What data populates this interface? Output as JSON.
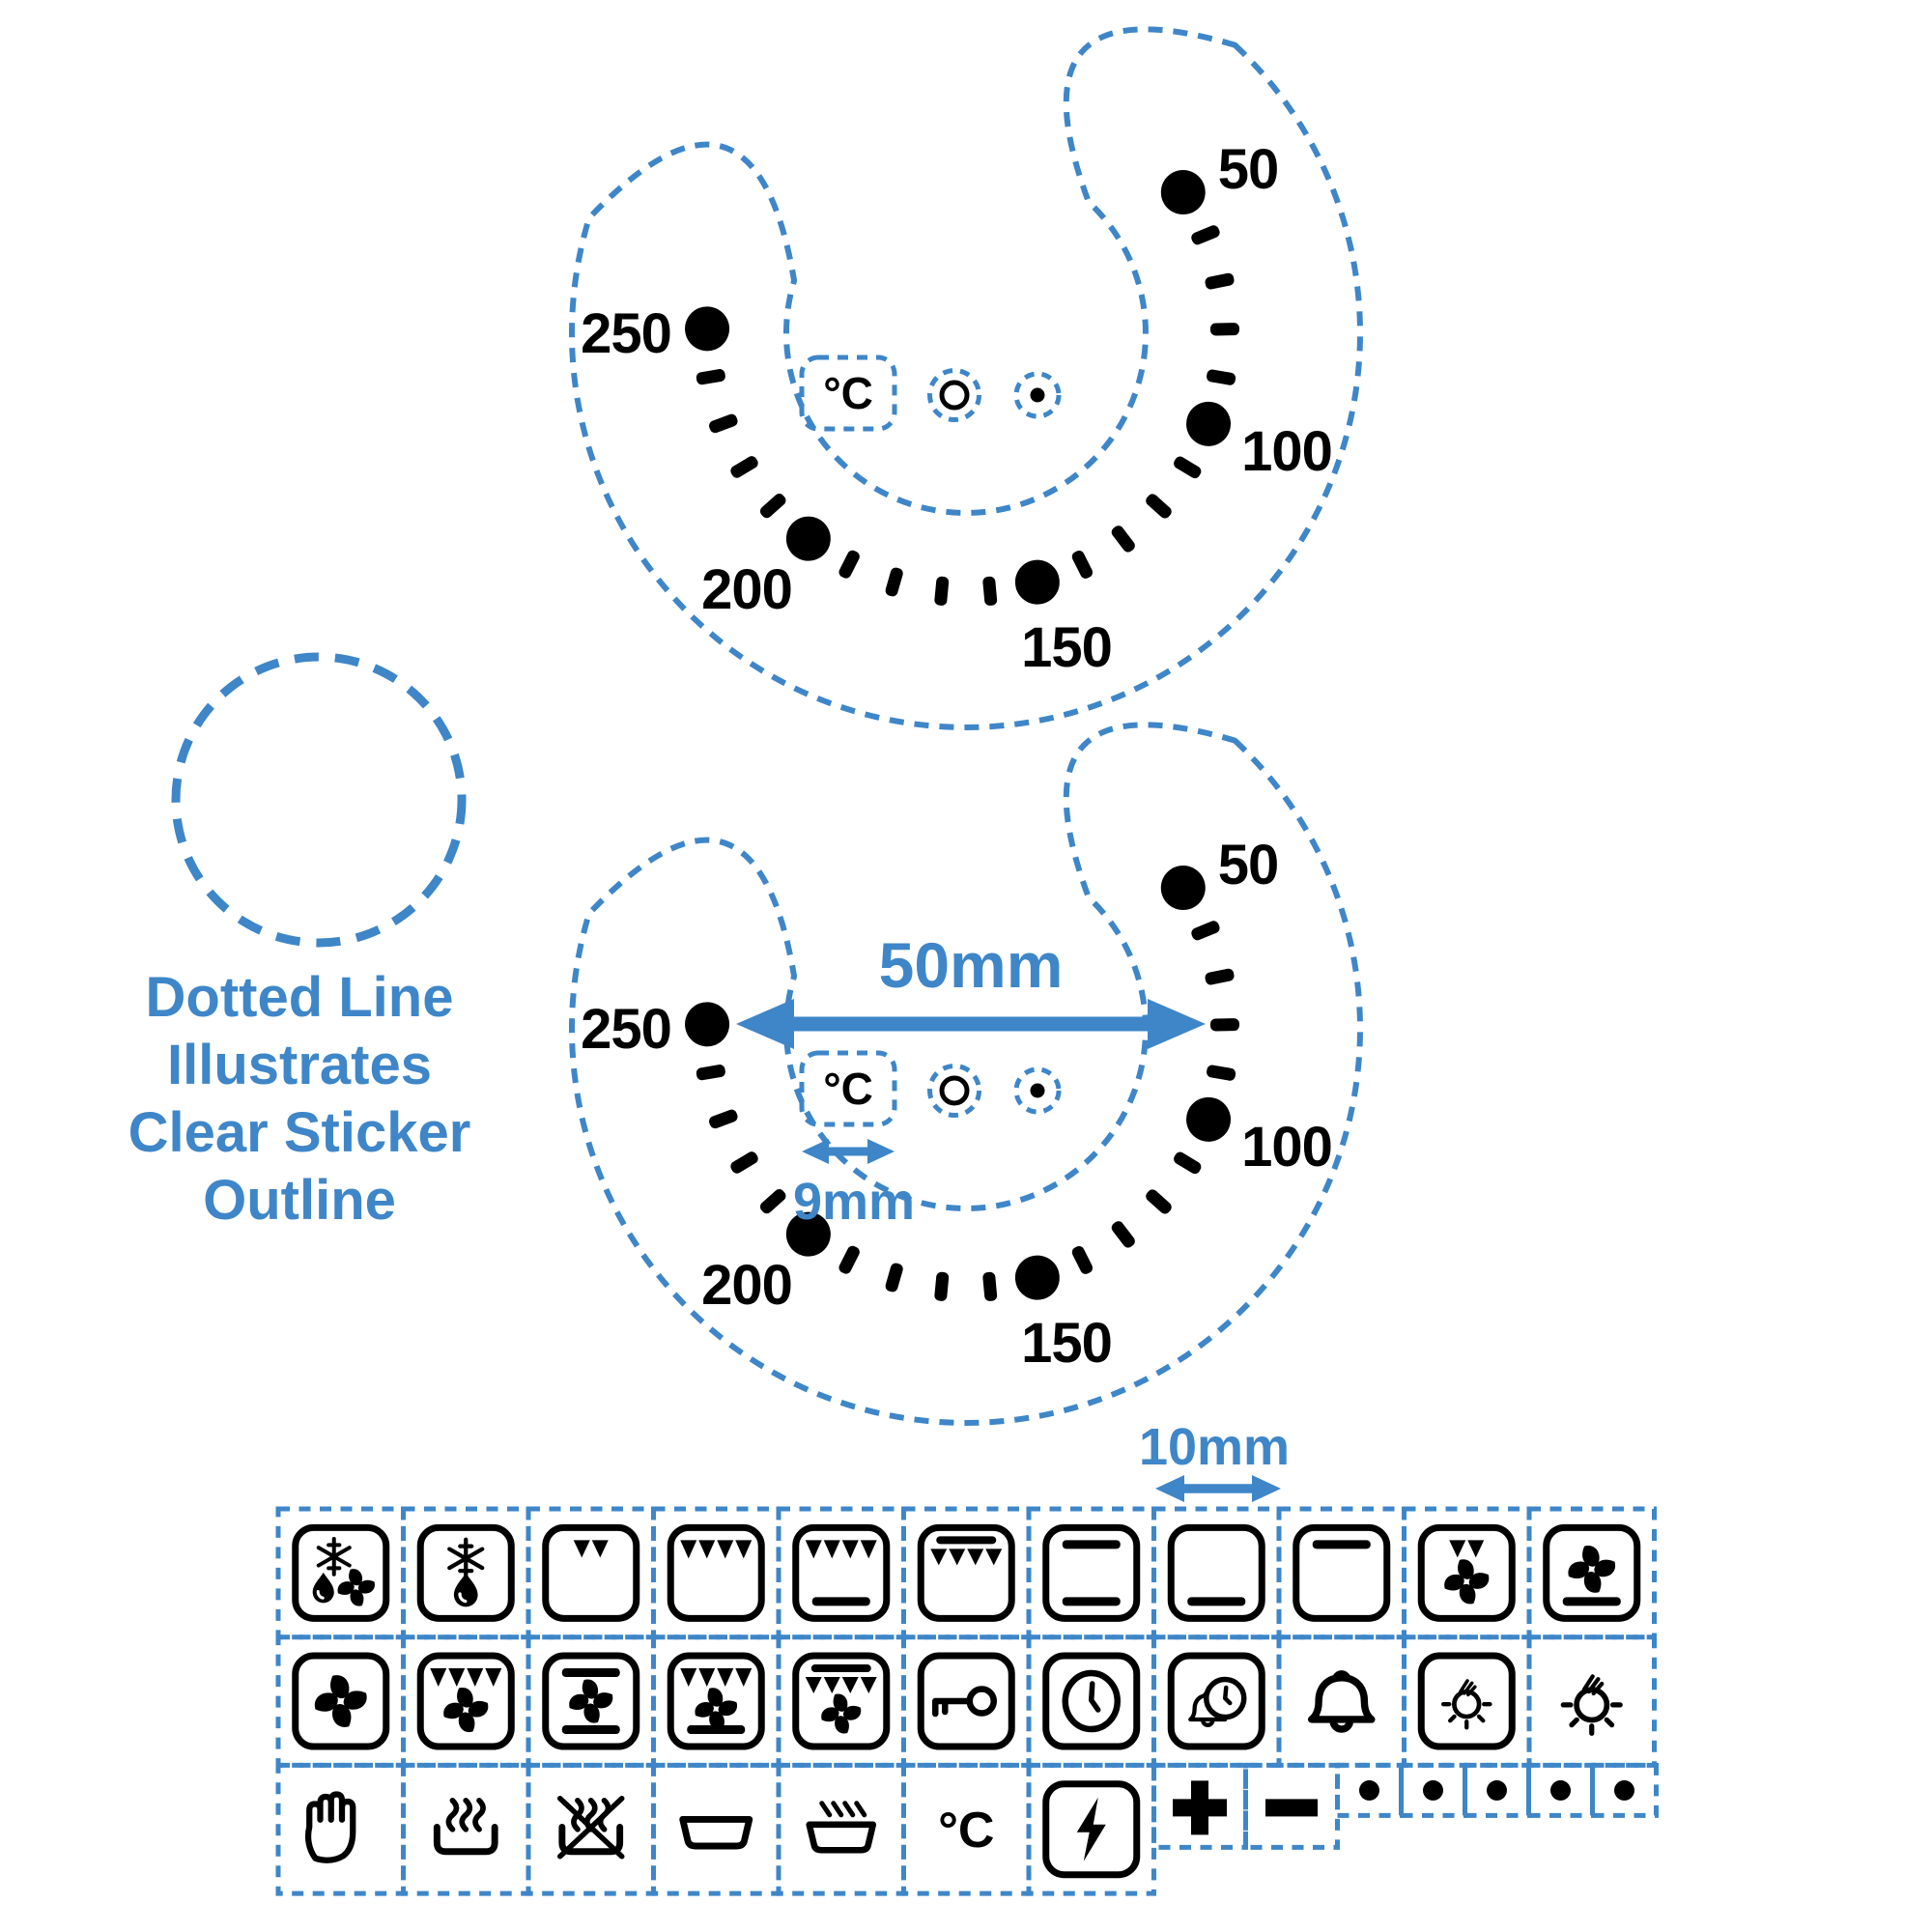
{
  "colors": {
    "accent_blue": "#3e86c8",
    "ink": "#000000",
    "background": "#ffffff"
  },
  "caption": {
    "lines": [
      "Dotted Line",
      "Illustrates",
      "Clear Sticker",
      "Outline"
    ]
  },
  "dials": [
    {
      "id": "top-dial",
      "scale_labels": [
        "50",
        "100",
        "150",
        "200",
        "250"
      ],
      "unit_label": "°C"
    },
    {
      "id": "bottom-dial",
      "scale_labels": [
        "50",
        "100",
        "150",
        "200",
        "250"
      ],
      "unit_label": "°C"
    }
  ],
  "measurements": {
    "dial_width": "50mm",
    "unit_box_width": "9mm",
    "symbol_cell_width": "10mm"
  },
  "grid_celsius": "°C",
  "sticker_grid": {
    "rows": [
      [
        {
          "icon": "defrost-fan"
        },
        {
          "icon": "defrost"
        },
        {
          "icon": "grill-small"
        },
        {
          "icon": "grill"
        },
        {
          "icon": "grill-bottom-heat"
        },
        {
          "icon": "top-heat-grill"
        },
        {
          "icon": "top-bottom-heat"
        },
        {
          "icon": "bottom-heat"
        },
        {
          "icon": "top-heat"
        },
        {
          "icon": "grill-small-fan"
        },
        {
          "icon": "fan-bottom-heat"
        }
      ],
      [
        {
          "icon": "fan"
        },
        {
          "icon": "grill-fan"
        },
        {
          "icon": "top-fan-bottom"
        },
        {
          "icon": "grill-fan-bottom"
        },
        {
          "icon": "top-grill-fan"
        },
        {
          "icon": "key"
        },
        {
          "icon": "clock"
        },
        {
          "icon": "alarm-clock"
        },
        {
          "icon": "bell"
        },
        {
          "icon": "lamp-framed"
        },
        {
          "icon": "lamp"
        }
      ],
      [
        {
          "icon": "hand"
        },
        {
          "icon": "steam"
        },
        {
          "icon": "no-steam"
        },
        {
          "icon": "dish"
        },
        {
          "icon": "hot-dish"
        },
        {
          "icon": "celsius"
        },
        {
          "icon": "power"
        },
        {
          "icon": "plus",
          "kind": "short"
        },
        {
          "icon": "minus",
          "kind": "short"
        },
        {
          "icon": "dot",
          "kind": "mini"
        },
        {
          "icon": "dot",
          "kind": "mini"
        },
        {
          "icon": "dot",
          "kind": "mini"
        },
        {
          "icon": "dot",
          "kind": "mini"
        },
        {
          "icon": "dot",
          "kind": "mini"
        }
      ]
    ]
  }
}
